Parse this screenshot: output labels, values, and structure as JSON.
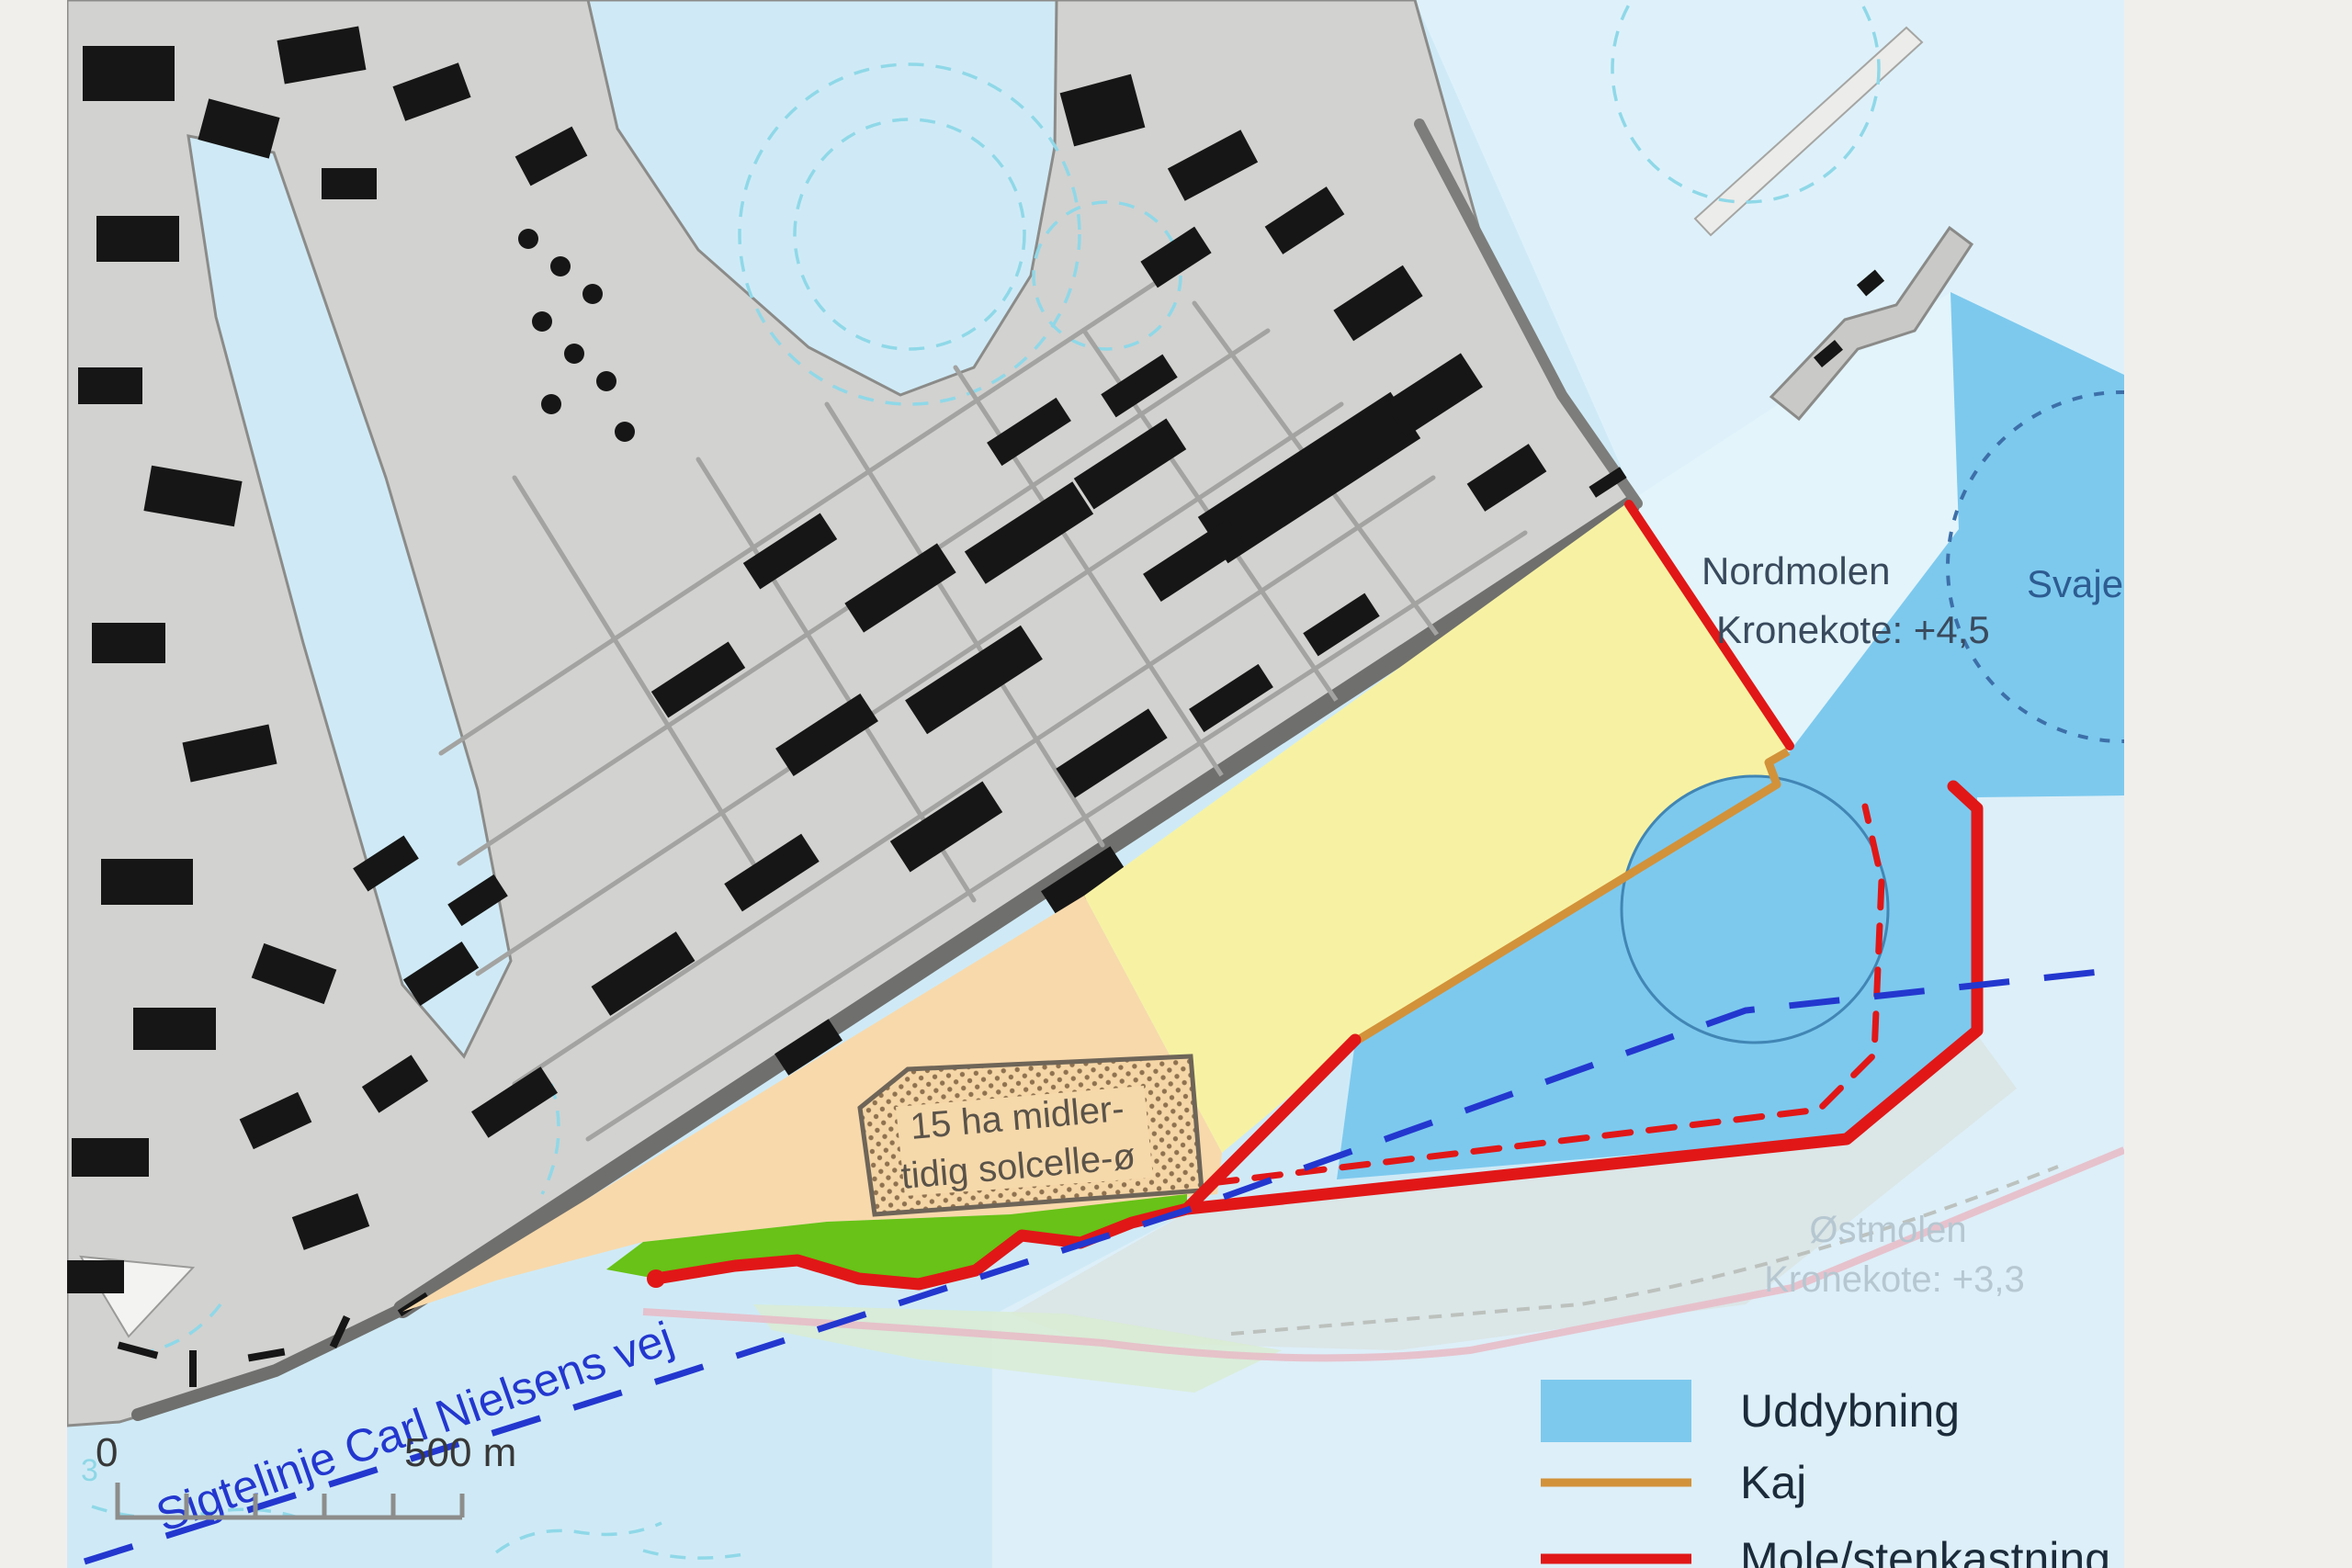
{
  "map": {
    "labels": {
      "nordmolen_line1": "Nordmolen",
      "nordmolen_line2": "Kronekote: +4,5",
      "svajebassin": "Svajeb",
      "ostmolen_line1": "Østmolen",
      "ostmolen_line2": "Kronekote: +3,3",
      "solar_island_line1": "15 ha midler-",
      "solar_island_line2": "tidig solcelle-ø",
      "sightline": "Sigtelinje Carl Nielsens vej",
      "depth_number": "3"
    },
    "scale_bar": {
      "start_label": "0",
      "end_label": "500 m"
    },
    "legend": {
      "items": [
        {
          "swatch": "area",
          "color": "#7dc9ee",
          "label": "Uddybning"
        },
        {
          "swatch": "line",
          "color": "#d2923a",
          "label": "Kaj"
        },
        {
          "swatch": "line",
          "color": "#e11717",
          "label": "Mole/stenkastning"
        }
      ]
    },
    "colors": {
      "frame_gray": "#f1efec",
      "water": "#cfeaf6",
      "water_pale": "#e3f4fb",
      "dredging_blue": "#7dc9ee",
      "land_gray": "#d2d2d0",
      "building_black": "#161616",
      "new_land_yellow": "#f7f2a3",
      "new_land_orange": "#f8d9ab",
      "green_edge": "#68c217",
      "mole_red": "#e11717",
      "quay_orange": "#d2923a",
      "sightline_blue": "#2337cf",
      "existing_mole_pink": "#e7bac6"
    }
  }
}
